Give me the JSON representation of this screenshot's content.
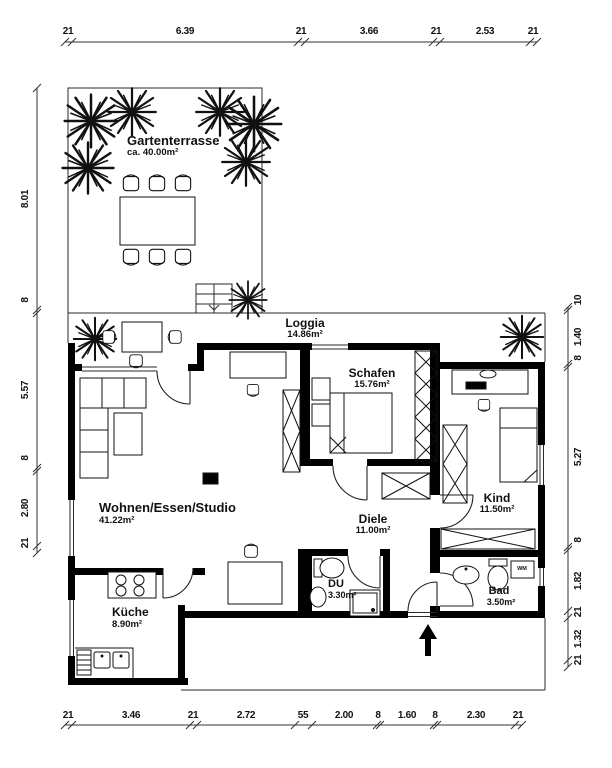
{
  "plan": {
    "rooms": {
      "gartenterrasse": {
        "name": "Gartenterrasse",
        "area": "ca. 40.00m²"
      },
      "loggia": {
        "name": "Loggia",
        "area": "14.86m²"
      },
      "schafen": {
        "name": "Schafen",
        "area": "15.76m²"
      },
      "kind": {
        "name": "Kind",
        "area": "11.50m²"
      },
      "wohnen": {
        "name": "Wohnen/Essen/Studio",
        "area": "41.22m²"
      },
      "diele": {
        "name": "Diele",
        "area": "11.00m²"
      },
      "du": {
        "name": "DU",
        "area": "3.30m²"
      },
      "bad": {
        "name": "Bad",
        "area": "3.50m²"
      },
      "kueche": {
        "name": "Küche",
        "area": "8.90m²"
      }
    },
    "appliances": {
      "washing_machine": "WM"
    },
    "dims": {
      "top": [
        "21",
        "6.39",
        "21",
        "3.66",
        "21",
        "2.53",
        "21"
      ],
      "bottom": [
        "21",
        "3.46",
        "21",
        "2.72",
        "55",
        "2.00",
        "8",
        "1.60",
        "8",
        "2.30",
        "21"
      ],
      "left": [
        "8.01",
        "8",
        "5.57",
        "8",
        "2.80",
        "21"
      ],
      "right": [
        "10",
        "1.40",
        "8",
        "5.27",
        "8",
        "1.82",
        "21",
        "1.32",
        "21"
      ]
    }
  }
}
